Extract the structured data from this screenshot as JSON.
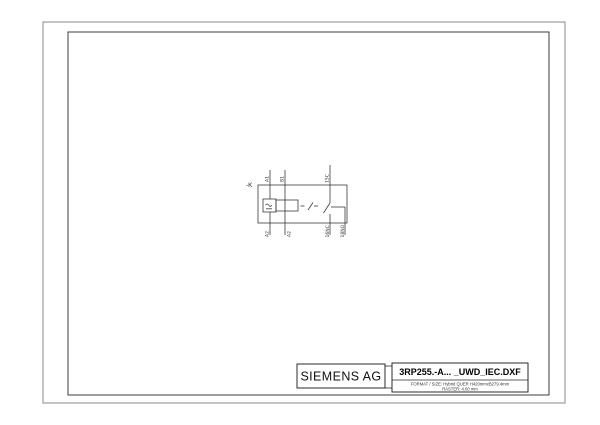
{
  "page": {
    "background": "#ffffff",
    "outer_border_color": "#8a8a8a",
    "inner_border_color": "#3c3c3c",
    "line_color": "#3a3a3a"
  },
  "schematic": {
    "device_tag": "-K",
    "coil_symbol": "ac-dc-coil-symbol",
    "terminals": {
      "top": [
        "A1",
        "B1",
        "15C"
      ],
      "bottom": [
        "A2",
        "A2",
        "16NC",
        "18NO"
      ]
    }
  },
  "title_block": {
    "company": "SIEMENS AG",
    "drawing_name": "3RP255.-A... _UWD_IEC.DXF",
    "format_line": "FORMAT / SIZE: Hybrid QUER H420mmxB279.4mm",
    "raster_line": "RASTER: 4.00 mm"
  }
}
